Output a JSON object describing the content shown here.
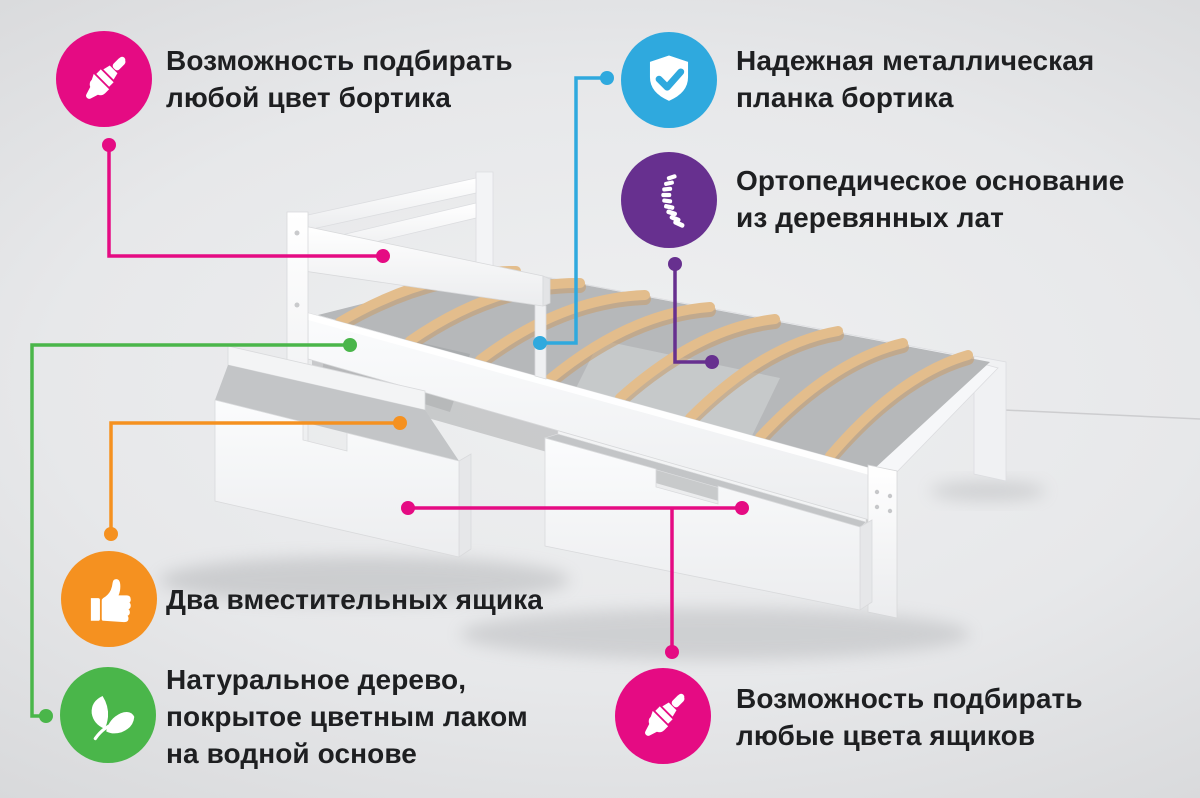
{
  "colors": {
    "pink": "#e50b83",
    "blue": "#2fa9de",
    "purple": "#67308f",
    "orange": "#f59120",
    "green": "#4ab64a",
    "text": "#1e1f21",
    "wood": "#e3bd8c",
    "wood_shadow": "#c7a072",
    "frame_white": "#fdfdfe",
    "frame_shade": "#e8e9eb",
    "interior_gray": "#b6b8ba",
    "background_center": "#eff0f1",
    "background_edge": "#c8c9cb"
  },
  "features": [
    {
      "id": "rail-any-color",
      "icon": "paintbrush-icon",
      "color": "pink",
      "lines": [
        "Возможность подбирать",
        "любой цвет бортика"
      ]
    },
    {
      "id": "metal-rail-plank",
      "icon": "shield-check-icon",
      "color": "blue",
      "lines": [
        "Надежная металлическая",
        "планка бортика"
      ]
    },
    {
      "id": "orthopedic-base",
      "icon": "spine-icon",
      "color": "purple",
      "lines": [
        "Ортопедическое основание",
        "из деревянных лат"
      ]
    },
    {
      "id": "two-drawers",
      "icon": "thumbs-up-icon",
      "color": "orange",
      "lines": [
        "Два вместительных ящика"
      ]
    },
    {
      "id": "natural-wood",
      "icon": "leaves-icon",
      "color": "green",
      "lines": [
        "Натуральное дерево,",
        "покрытое цветным лаком",
        "на водной основе"
      ]
    },
    {
      "id": "drawers-any-color",
      "icon": "paintbrush-icon",
      "color": "pink",
      "lines": [
        "Возможность подбирать",
        "любые цвета ящиков"
      ]
    }
  ]
}
